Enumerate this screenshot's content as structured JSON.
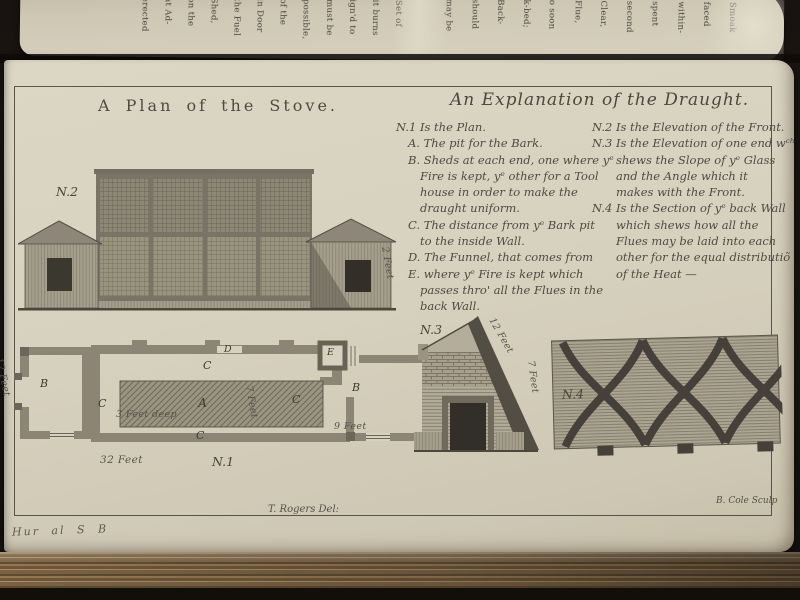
{
  "plate": {
    "title_left": "A Plan of the Stove.",
    "title_right": "An Explanation of the Draught.",
    "explanation_left": [
      "N.1 Is the Plan.",
      "A. The pit for the Bark.",
      "B. Sheds at each end, one where yᵉ",
      "Fire is kept, yᵉ other for a Tool",
      "house in order to make the",
      "draught uniform.",
      "C. The distance from yᵉ Bark pit",
      "to the inside Wall.",
      "D. The Funnel, that comes from",
      "E. where yᵉ Fire is kept which",
      "passes thro' all the Flues in the",
      "back Wall."
    ],
    "explanation_right": [
      "N.2 Is the Elevation of the Front.",
      "N.3 Is the Elevation of one end wᶜʰ",
      "shews the Slope of yᵉ Glass",
      "and the Angle which it",
      "makes with the Front.",
      "N.4 Is the Section of yᵉ back Wall",
      "which shews how all the",
      "Flues may be laid into each",
      "other for the equal distributiõ",
      "of the Heat —"
    ],
    "credit_left": "T. Rogers Del:",
    "credit_right": "B. Cole Sculp",
    "inscription": "Hur al S B"
  },
  "figures": {
    "n1": {
      "label": "N.1",
      "pit_label": "A",
      "room_label": "B",
      "corridor_label": "C",
      "wall_label": "D",
      "furnace_label": "E",
      "dim_length": "32 Feet",
      "dim_room": "9 Feet",
      "dim_width": "12 Feet",
      "dim_pit": "7 Feet",
      "dim_depth": "3 Feet deep"
    },
    "n2": {
      "label": "N.2",
      "dim_wall": "2 Feet"
    },
    "n3": {
      "label": "N.3",
      "dim_slope": "12 Feet",
      "dim_height": "7 Feet"
    },
    "n4": {
      "label": "N.4"
    }
  },
  "top_edge": {
    "fragments": [
      "erected",
      "at Ad-",
      "on the",
      "Shed,",
      "the Fuel",
      "in Door",
      "of the",
      "possible,",
      "must be",
      "ign'd to",
      "it burns",
      "Set of",
      "may be",
      "should",
      "Back-",
      "k-bed;",
      "o soon",
      "Flue,",
      "Clear,",
      "second",
      "spent",
      "within-",
      "faced",
      "Smoak"
    ]
  }
}
